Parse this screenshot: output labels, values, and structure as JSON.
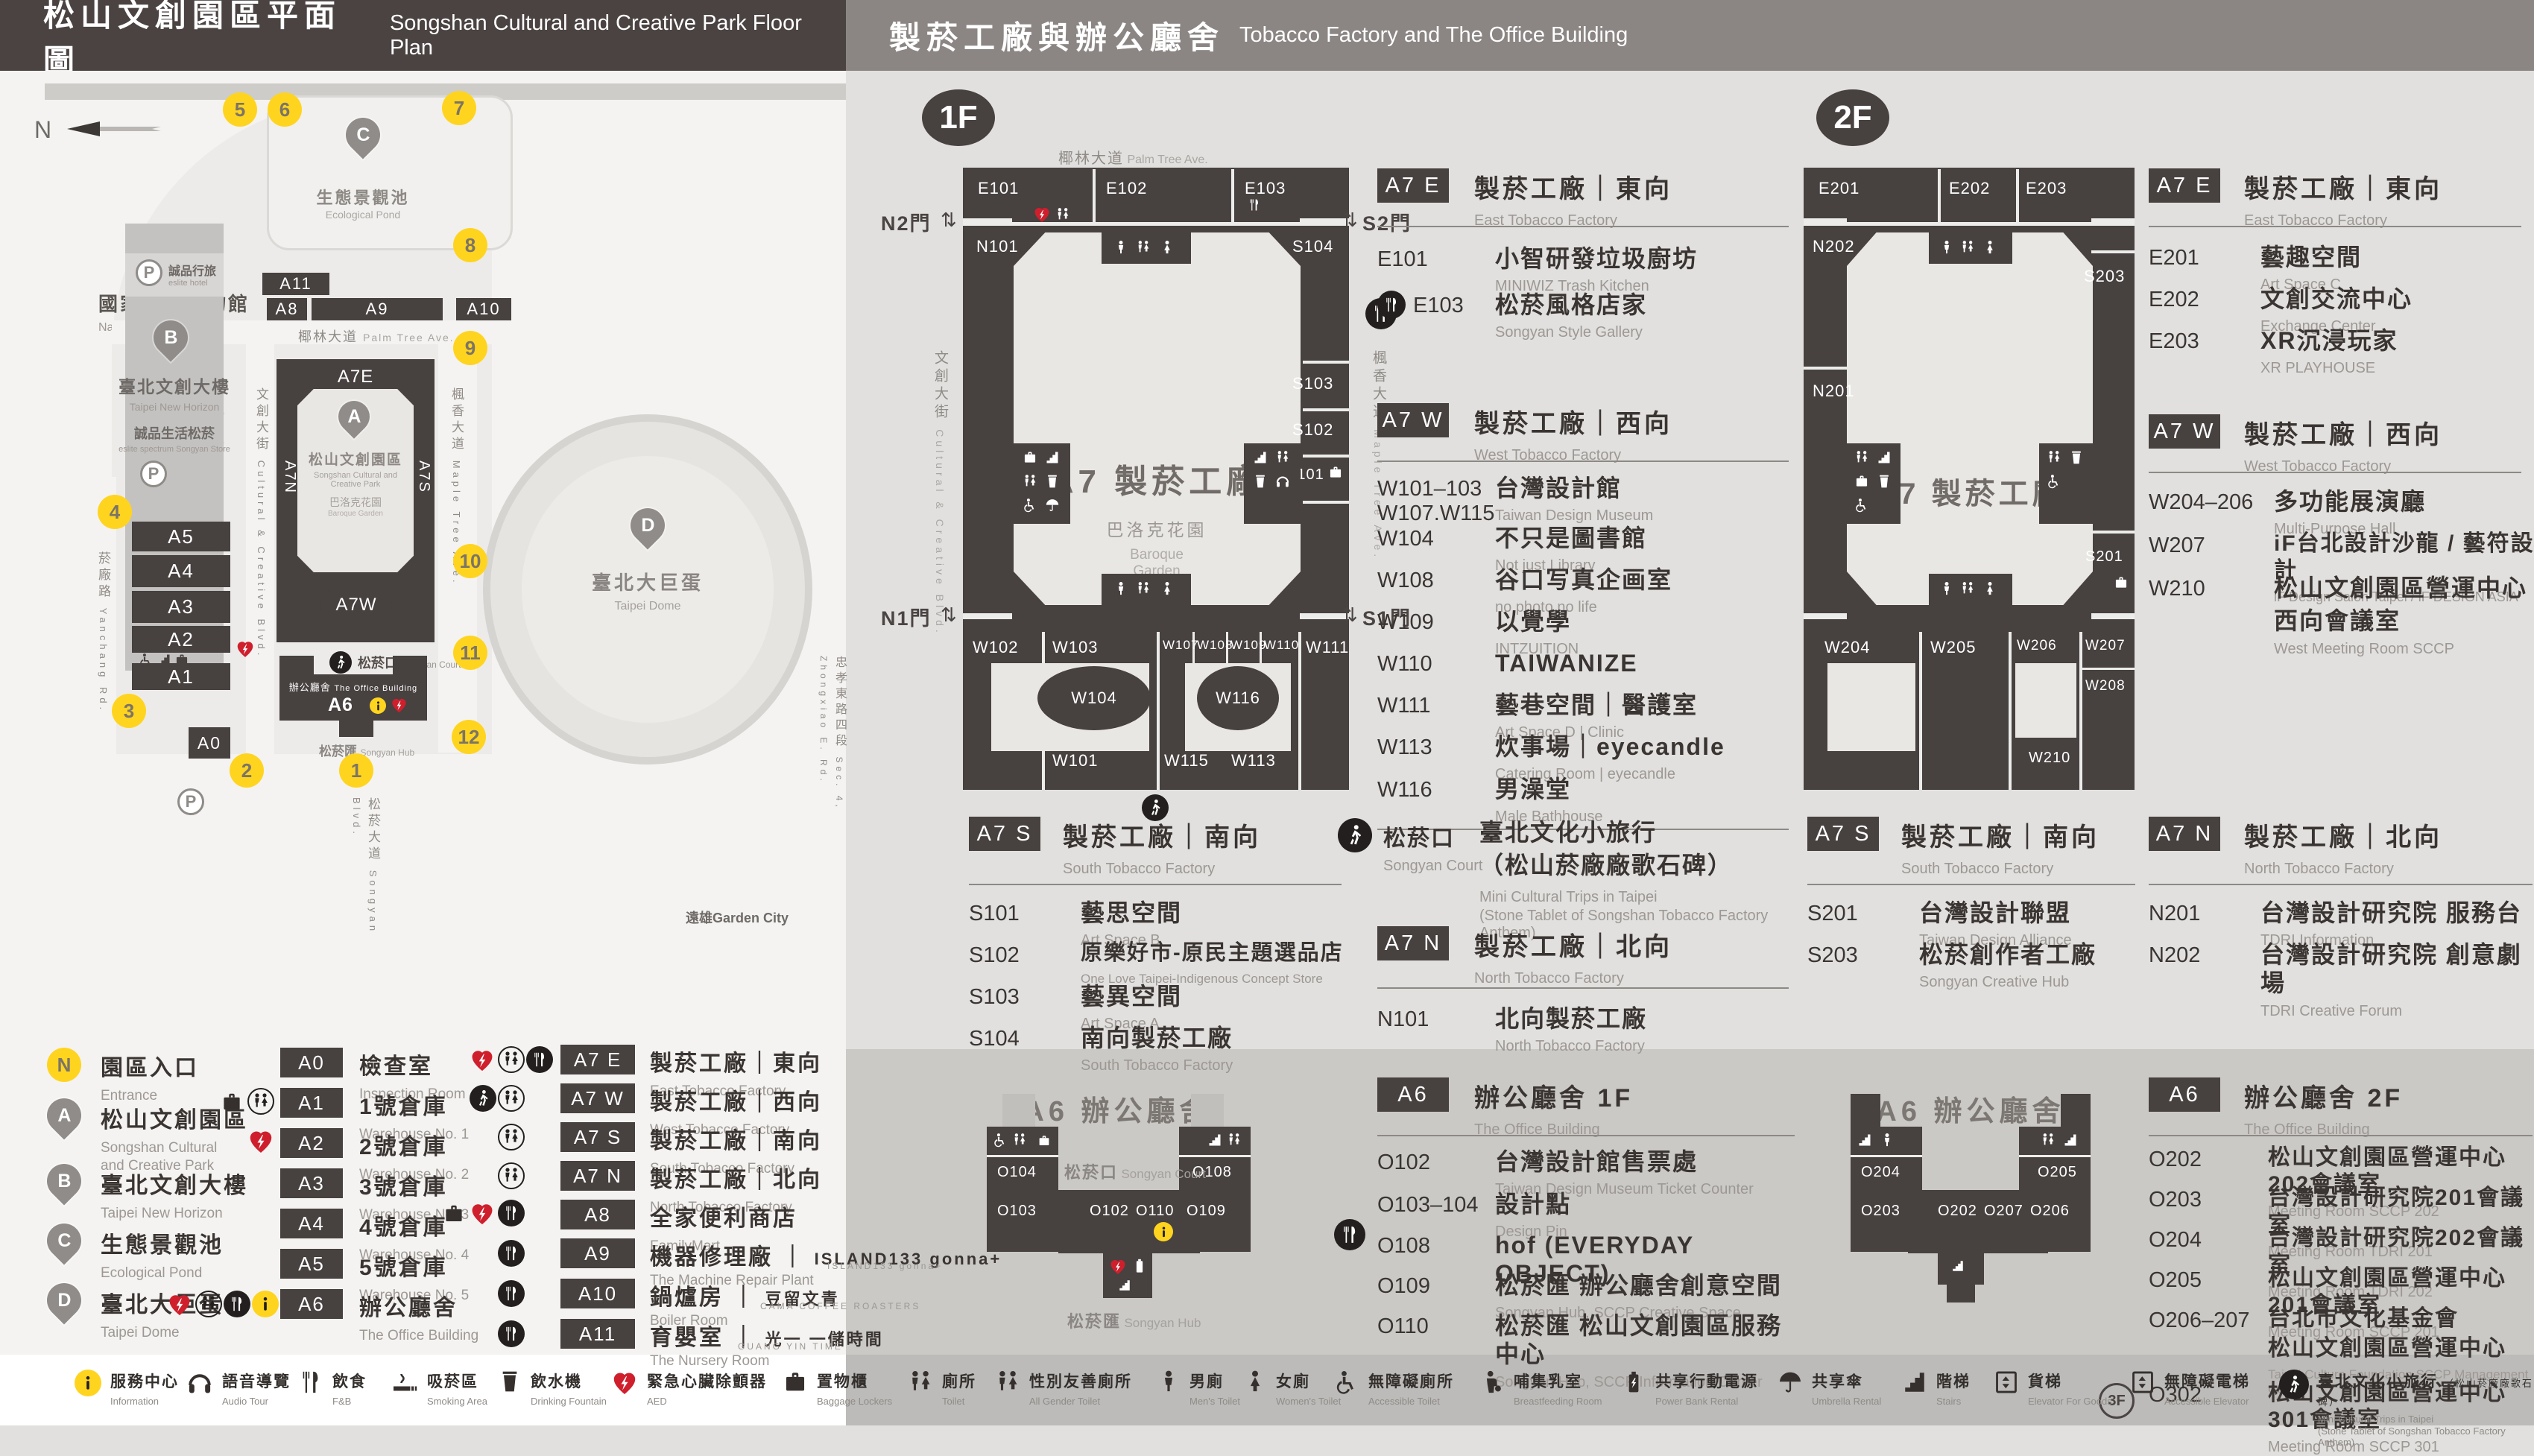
{
  "colors": {
    "dark": "#474140",
    "header_left": "#4a4342",
    "header_right": "#8b8684",
    "yellow": "#ffd41f",
    "red": "#cf1f2c"
  },
  "header": {
    "left_zh": "松山文創園區平面圖",
    "left_en": "Songshan Cultural and Creative Park Floor Plan",
    "right_zh": "製菸工廠與辦公廳舍",
    "right_en": "Tobacco Factory and The Office Building"
  },
  "park": {
    "compass": "N",
    "railway_zh": "國家鐵道博物館",
    "railway_en": "National Railway Museum",
    "palm_zh": "椰林大道",
    "palm_en": "Palm Tree Ave.",
    "pond_zh": "生態景觀池",
    "pond_en": "Ecological Pond",
    "horizon_zh": "臺北文創大樓",
    "horizon_en": "Taipei New Horizon",
    "eslite_hotel_zh": "誠品行旅",
    "eslite_hotel_en": "eslite hotel",
    "eslite_store_zh": "誠品生活松菸",
    "eslite_store_en": "eslite spectrum Songyan Store",
    "plaza_zh": "文化廣場",
    "plaza_en": "Cultural Plaza",
    "blvd_zh": "文創大街",
    "blvd_en": "Cultural & Creative Blvd.",
    "maple_zh": "楓香大道",
    "maple_en": "Maple Tree Ave.",
    "yanchang_zh": "菸廠路",
    "yanchang_en": "Yanchang Rd.",
    "park_zh": "松山文創園區",
    "park_en1": "Songshan Cultural and",
    "park_en2": "Creative Park",
    "baroque_zh": "巴洛克花園",
    "baroque_en": "Baroque Garden",
    "court_zh": "松菸口",
    "court_en": "Songyan Court",
    "office_zh": "辦公廳舍",
    "office_en": "The Office Building",
    "hub_zh": "松菸匯",
    "hub_en": "Songyan Hub",
    "dome_zh": "臺北大巨蛋",
    "dome_en": "Taipei Dome",
    "songyan_blvd_zh": "松菸大道",
    "songyan_blvd_en": "Songyan Blvd.",
    "zhongxiao_zh": "忠孝東路四段",
    "zhongxiao_en": "Sec. 4, Zhongxiao E. Rd.",
    "garden_city": "遠雄Garden City",
    "parking": "P",
    "labels": {
      "a7e": "A7E",
      "a7w": "A7W",
      "a7n": "A7N",
      "a7s": "A7S",
      "a0": "A0",
      "a1": "A1",
      "a2": "A2",
      "a3": "A3",
      "a4": "A4",
      "a5": "A5",
      "a6": "A6",
      "a8": "A8",
      "a9": "A9",
      "a10": "A10",
      "a11": "A11"
    },
    "pins": {
      "a": "A",
      "b": "B",
      "c": "C",
      "d": "D"
    },
    "entrances": [
      "1",
      "2",
      "3",
      "4",
      "5",
      "6",
      "7",
      "8",
      "9",
      "10",
      "11",
      "12"
    ]
  },
  "legend": {
    "places": [
      {
        "key": "N",
        "zh": "園區入口",
        "en1": "Entrance",
        "en2": ""
      },
      {
        "key": "A",
        "zh": "松山文創園區",
        "en1": "Songshan Cultural",
        "en2": "and Creative Park"
      },
      {
        "key": "B",
        "zh": "臺北文創大樓",
        "en1": "Taipei New Horizon",
        "en2": ""
      },
      {
        "key": "C",
        "zh": "生態景觀池",
        "en1": "Ecological Pond",
        "en2": ""
      },
      {
        "key": "D",
        "zh": "臺北大巨蛋",
        "en1": "Taipei Dome",
        "en2": ""
      }
    ],
    "col_a": [
      {
        "code": "A0",
        "zh": "檢查室",
        "en": "Inspection Room"
      },
      {
        "code": "A1",
        "zh": "1號倉庫",
        "en": "Warehouse No. 1"
      },
      {
        "code": "A2",
        "zh": "2號倉庫",
        "en": "Warehouse No. 2"
      },
      {
        "code": "A3",
        "zh": "3號倉庫",
        "en": "Warehouse No. 3"
      },
      {
        "code": "A4",
        "zh": "4號倉庫",
        "en": "Warehouse No. 4"
      },
      {
        "code": "A5",
        "zh": "5號倉庫",
        "en": "Warehouse No. 5"
      },
      {
        "code": "A6",
        "zh": "辦公廳舍",
        "en": "The Office Building"
      }
    ],
    "col_b": [
      {
        "code": "A7 E",
        "zh": "製菸工廠｜東向",
        "en": "East Tobacco Factory"
      },
      {
        "code": "A7 W",
        "zh": "製菸工廠｜西向",
        "en": "West Tobacco Factory"
      },
      {
        "code": "A7 S",
        "zh": "製菸工廠｜南向",
        "en": "South Tobacco Factory"
      },
      {
        "code": "A7 N",
        "zh": "製菸工廠｜北向",
        "en": "North Tobacco Factory"
      },
      {
        "code": "A8",
        "zh": "全家便利商店",
        "en": "FamilyMart"
      },
      {
        "code": "A9",
        "zh": "機器修理廠",
        "brand": "ISLAND133 gonna+",
        "brand_en": "ISLAND133 gonna+",
        "en": "The Machine Repair Plant"
      },
      {
        "code": "A10",
        "zh": "鍋爐房",
        "brand": "豆留文青",
        "brand_en": "CAMA COFFEE ROASTERS",
        "en": "Boiler Room"
      },
      {
        "code": "A11",
        "zh": "育嬰室",
        "brand": "光一 一儲時間",
        "brand_en": "GUANG YIN TIME",
        "en": "The Nursery Room"
      }
    ]
  },
  "f1": {
    "badge": "1F",
    "map": {
      "street_top_zh": "椰林大道",
      "street_top_en": "Palm Tree Ave.",
      "street_left_zh": "文創大街",
      "street_left_en": "Cultural & Creative Blvd.",
      "street_right_zh": "楓香大道",
      "street_right_en": "Maple Tree Ave.",
      "center": "A7 製菸工廠",
      "garden_zh": "巴洛克花園",
      "garden_en1": "Baroque",
      "garden_en2": "Garden",
      "gate_n2": "N2門",
      "gate_s2": "S2門",
      "gate_n1": "N1門",
      "gate_s1": "S1門",
      "rooms": {
        "e101": "E101",
        "e102": "E102",
        "e103": "E103",
        "n101": "N101",
        "s104": "S104",
        "s103": "S103",
        "s102": "S102",
        "s101": "S101",
        "w102": "W102",
        "w103": "W103",
        "w104": "W104",
        "w107": "W107",
        "w108": "W108",
        "w109": "W109",
        "w110": "W110",
        "w111": "W111",
        "w116": "W116",
        "w101": "W101",
        "w115": "W115",
        "w113": "W113"
      }
    },
    "a7e": {
      "code": "A7 E",
      "zh": "製菸工廠｜東向",
      "en": "East Tobacco Factory",
      "rooms": [
        {
          "code": "E101",
          "zh": "小智研發垃圾廚坊",
          "en": "MINIWIZ Trash Kitchen"
        },
        {
          "code": "E103",
          "zh": "松菸風格店家",
          "en": "Songyan Style Gallery"
        }
      ]
    },
    "a7w": {
      "code": "A7 W",
      "zh": "製菸工廠｜西向",
      "en": "West Tobacco Factory",
      "rooms": [
        {
          "code": "W101–103",
          "code2": "W107.W115",
          "zh": "台灣設計館",
          "en": "Taiwan Design Museum"
        },
        {
          "code": "W104",
          "zh": "不只是圖書館",
          "en": "Not just Library"
        },
        {
          "code": "W108",
          "zh": "谷口写真企画室",
          "en": "no photo no life"
        },
        {
          "code": "W109",
          "zh": "以覺學",
          "en": "INTZUITION"
        },
        {
          "code": "W110",
          "zh": "TAIWANIZE",
          "en": ""
        },
        {
          "code": "W111",
          "zh": "藝巷空間｜醫護室",
          "en": "Art Space D | Clinic"
        },
        {
          "code": "W113",
          "zh": "炊事場｜eyecandle",
          "en": "Catering Room | eyecandle"
        },
        {
          "code": "W116",
          "zh": "男澡堂",
          "en": "Male Bathhouse"
        }
      ]
    },
    "a7s": {
      "code": "A7 S",
      "zh": "製菸工廠｜南向",
      "en": "South Tobacco Factory",
      "rooms": [
        {
          "code": "S101",
          "zh": "藝思空間",
          "en": "Art Space B"
        },
        {
          "code": "S102",
          "zh": "原樂好市-原民主題選品店",
          "en": "One Love Taipei-Indigenous Concept Store"
        },
        {
          "code": "S103",
          "zh": "藝異空間",
          "en": "Art Space A"
        },
        {
          "code": "S104",
          "zh": "南向製菸工廠",
          "en": "South Tobacco Factory"
        }
      ]
    },
    "court": {
      "zh": "松菸口",
      "en": "Songyan Court",
      "d1": "臺北文化小旅行",
      "d2": "（松山菸廠廠歌石碑）",
      "e1": "Mini Cultural Trips in Taipei",
      "e2": "(Stone Tablet of Songshan Tobacco Factory Anthem)"
    },
    "a7n": {
      "code": "A7 N",
      "zh": "製菸工廠｜北向",
      "en": "North Tobacco Factory",
      "rooms": [
        {
          "code": "N101",
          "zh": "北向製菸工廠",
          "en": "North Tobacco Factory"
        }
      ]
    },
    "a6": {
      "code": "A6",
      "zh": "辦公廳舍 1F",
      "en": "The Office Building",
      "rooms": [
        {
          "code": "O102",
          "zh": "台灣設計館售票處",
          "en": "Taiwan Design Museum Ticket Counter"
        },
        {
          "code": "O103–104",
          "zh": "設計點",
          "en": "Design Pin"
        },
        {
          "code": "O108",
          "zh": "hof (EVERYDAY OBJECT)",
          "en": ""
        },
        {
          "code": "O109",
          "zh": "松菸匯 辦公廳舍創意空間",
          "en": "Songyan Hub, SCCP Creative Space"
        },
        {
          "code": "O110",
          "zh": "松菸匯 松山文創園區服務中心",
          "en": "Songyan Hub, SCCP Information Center"
        }
      ]
    },
    "a6map": {
      "title": "A6 辦公廳舍",
      "court_zh": "松菸口",
      "court_en": "Songyan Court",
      "hub_zh": "松菸匯",
      "hub_en": "Songyan Hub",
      "rooms": {
        "o104": "O104",
        "o103": "O103",
        "o102": "O102",
        "o110": "O110",
        "o109": "O109",
        "o108": "O108"
      }
    }
  },
  "f2": {
    "badge": "2F",
    "map": {
      "center": "A7 製菸工廠",
      "rooms": {
        "e201": "E201",
        "e202": "E202",
        "e203": "E203",
        "n202": "N202",
        "n201": "N201",
        "s203": "S203",
        "s201": "S201",
        "w204": "W204",
        "w205": "W205",
        "w206": "W206",
        "w207": "W207",
        "w208": "W208",
        "w210": "W210"
      }
    },
    "a7e": {
      "code": "A7 E",
      "zh": "製菸工廠｜東向",
      "en": "East Tobacco Factory",
      "rooms": [
        {
          "code": "E201",
          "zh": "藝趣空間",
          "en": "Art Space C"
        },
        {
          "code": "E202",
          "zh": "文創交流中心",
          "en": "Exchange Center"
        },
        {
          "code": "E203",
          "zh": "XR沉浸玩家",
          "en": "XR PLAYHOUSE"
        }
      ]
    },
    "a7w": {
      "code": "A7 W",
      "zh": "製菸工廠｜西向",
      "en": "West Tobacco Factory",
      "rooms": [
        {
          "code": "W204–206",
          "zh": "多功能展演廳",
          "en": "Multi-Purpose Hall"
        },
        {
          "code": "W207",
          "zh": "iF台北設計沙龍 / 藝符設計",
          "en": "iF Design Salon Taipei / iF DESIGN ASIA"
        },
        {
          "code": "W210",
          "zh": "松山文創園區營運中心",
          "zh2": "西向會議室",
          "en": "West Meeting Room SCCP"
        }
      ]
    },
    "a7s": {
      "code": "A7 S",
      "zh": "製菸工廠｜南向",
      "en": "South Tobacco Factory",
      "rooms": [
        {
          "code": "S201",
          "zh": "台灣設計聯盟",
          "en": "Taiwan Design Alliance"
        },
        {
          "code": "S203",
          "zh": "松菸創作者工廠",
          "en": "Songyan Creative Hub"
        }
      ]
    },
    "a7n": {
      "code": "A7 N",
      "zh": "製菸工廠｜北向",
      "en": "North Tobacco Factory",
      "rooms": [
        {
          "code": "N201",
          "zh": "台灣設計研究院 服務台",
          "en": "TDRI Information"
        },
        {
          "code": "N202",
          "zh": "台灣設計研究院 創意劇場",
          "en": "TDRI Creative Forum"
        }
      ]
    },
    "a6": {
      "code": "A6",
      "zh": "辦公廳舍 2F",
      "en": "The Office Building",
      "rooms": [
        {
          "code": "O202",
          "zh": "松山文創園區營運中心202會議室",
          "en": "Meeting Room SCCP 202"
        },
        {
          "code": "O203",
          "zh": "台灣設計研究院201會議室",
          "en": "Meeting Room TDRI 201"
        },
        {
          "code": "O204",
          "zh": "台灣設計研究院202會議室",
          "en": "Meeting Room TDRI 202"
        },
        {
          "code": "O205",
          "zh": "松山文創園區營運中心201會議室",
          "en": "Meeting Room SCCP 201"
        },
        {
          "code": "O206–207",
          "zh": "台北市文化基金會",
          "zh2": "松山文創園區營運中心",
          "en": "Taipei Culture Foundation SCCP Management Center"
        },
        {
          "code": "O302",
          "floor": "3F",
          "zh": "松山文創園區營運中心301會議室",
          "en": "Meeting Room SCCP 301"
        }
      ]
    },
    "a6map": {
      "title": "A6 辦公廳舍",
      "rooms": {
        "o204": "O204",
        "o203": "O203",
        "o202": "O202",
        "o207": "O207",
        "o206": "O206",
        "o205": "O205"
      }
    }
  },
  "strip": [
    {
      "zh": "服務中心",
      "en": "Information"
    },
    {
      "zh": "語音導覽",
      "en": "Audio Tour"
    },
    {
      "zh": "飲食",
      "en": "F&B"
    },
    {
      "zh": "吸菸區",
      "en": "Smoking Area"
    },
    {
      "zh": "飲水機",
      "en": "Drinking Fountain"
    },
    {
      "zh": "緊急心臟除顫器",
      "en": "AED"
    },
    {
      "zh": "置物櫃",
      "en": "Baggage Lockers"
    },
    {
      "zh": "廁所",
      "en": "Toilet"
    },
    {
      "zh": "性別友善廁所",
      "en": "All Gender Toilet"
    },
    {
      "zh": "男廁",
      "en": "Men's Toilet"
    },
    {
      "zh": "女廁",
      "en": "Women's Toilet"
    },
    {
      "zh": "無障礙廁所",
      "en": "Accessible Toilet"
    },
    {
      "zh": "哺集乳室",
      "en": "Breastfeeding Room"
    },
    {
      "zh": "共享行動電源",
      "en": "Power Bank Rental"
    },
    {
      "zh": "共享傘",
      "en": "Umbrella Rental"
    },
    {
      "zh": "階梯",
      "en": "Stairs"
    },
    {
      "zh": "貨梯",
      "en": "Elevator For Goods"
    },
    {
      "zh": "無障礙電梯",
      "en": "Accessible Elevator"
    },
    {
      "zh": "臺北文化小旅行",
      "zh_sub": "（松山菸廠廠歌石碑）",
      "en": "Mini Cultural Trips in Taipei",
      "en2": "(Stone Tablet of Songshan Tobacco Factory Anthem)"
    }
  ]
}
